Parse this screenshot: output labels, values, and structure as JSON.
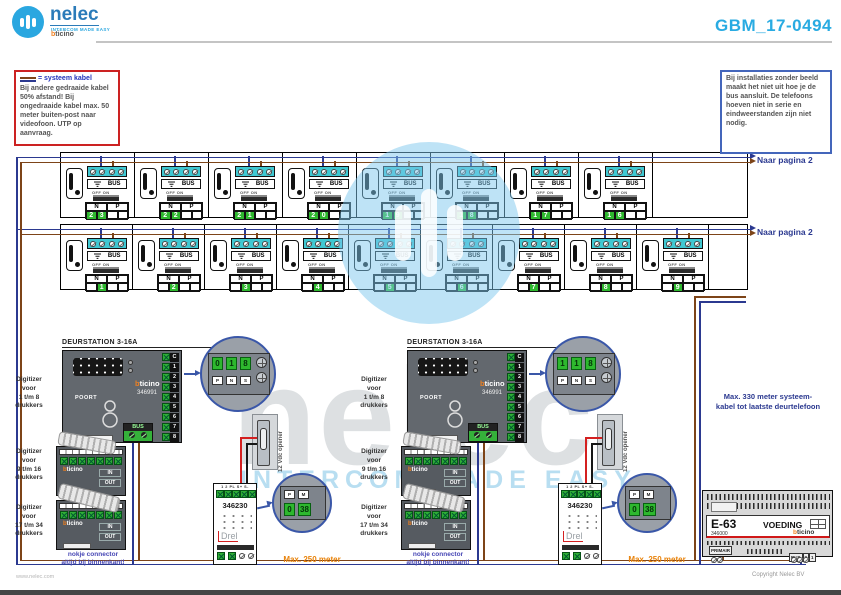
{
  "header": {
    "brand": "nelec",
    "tagline": "INTERCOM MADE EASY",
    "partner": "bticino",
    "doc_number": "GBM_17-0494"
  },
  "notes": {
    "left_legend": "= systeem kabel",
    "left_body": "Bij andere gedraaide kabel 50% afstand! Bij ongedraaide kabel max. 50 meter buiten-post naar videofoon. UTP op aanvraag.",
    "right_body": "Bij installaties zonder beeld maakt het niet uit hoe je de bus aansluit. De telefoons hoeven niet in serie en eindweerstanden zijn niet nodig."
  },
  "rows": {
    "label_naar_pagina": "Naar pagina 2",
    "labels": {
      "n": "N",
      "p": "P",
      "bus": "BUS",
      "onoff": "OFF ON"
    },
    "row1_units": [
      "23",
      "22",
      "21",
      "20",
      "19",
      "18",
      "17",
      "16"
    ],
    "row2_units": [
      "1",
      "2",
      "3",
      "4",
      "5",
      "6",
      "7",
      "8",
      "9"
    ]
  },
  "stations": [
    {
      "title": "DEURSTATION 3-16A",
      "brand": "bticino",
      "model": "346991",
      "panel_label": "POORT",
      "bus_label": "BUS",
      "terminals": [
        "C",
        "1",
        "2",
        "3",
        "4",
        "5",
        "6",
        "7",
        "8"
      ],
      "circle": {
        "digits": [
          "0",
          "1",
          "8"
        ],
        "labels": [
          "P",
          "N",
          "S"
        ]
      }
    },
    {
      "title": "DEURSTATION 3-16A",
      "brand": "bticino",
      "model": "346991",
      "panel_label": "POORT",
      "bus_label": "BUS",
      "terminals": [
        "C",
        "1",
        "2",
        "3",
        "4",
        "5",
        "6",
        "7",
        "8"
      ],
      "circle": {
        "digits": [
          "1",
          "1",
          "8"
        ],
        "labels": [
          "P",
          "N",
          "S"
        ]
      }
    }
  ],
  "digitizer_labels": [
    "Digitizer\nvoor\n1 t/m 8\ndrukkers",
    "Digitizer\nvoor\n9 t/m 16\ndrukkers",
    "Digitizer\nvoor\n17 t/m 34\ndrukkers"
  ],
  "digitizer_module": {
    "brand": "bticino",
    "in": "IN",
    "out": "OUT"
  },
  "psu_module": {
    "model": "346230",
    "terminals": "1  2  PL  S+  S-",
    "print": "Drel",
    "circle": {
      "labels": [
        "P",
        "M"
      ],
      "digits": [
        "0",
        "38"
      ]
    }
  },
  "opener_label": "12 Vdc opener",
  "power_supply": {
    "name": "E-63",
    "code": "346000",
    "label": "VOEDING",
    "brand": "bticino",
    "primair": "PRIMAIR",
    "bus_terms": [
      "BUS",
      "2",
      "1"
    ]
  },
  "annotations": {
    "max_system": "Max. 330 meter systeem-\nkabel tot laatste deurtelefoon",
    "max_meter": "Max. 250 meter",
    "connector_note": "nokje connector\naltijd bij binnenkant!",
    "copyright": "Copyright Nelec BV",
    "website": "www.nelec.com"
  },
  "watermark": {
    "brand": "nelec",
    "tagline": "INTERCOM MADE EASY"
  },
  "colors": {
    "accent": "#29abe2",
    "wire_blue": "#2b3990",
    "wire_brown": "#7d4418",
    "green": "#2eb82e",
    "cyan": "#3fc8d2",
    "orange_text": "#e8820a"
  }
}
